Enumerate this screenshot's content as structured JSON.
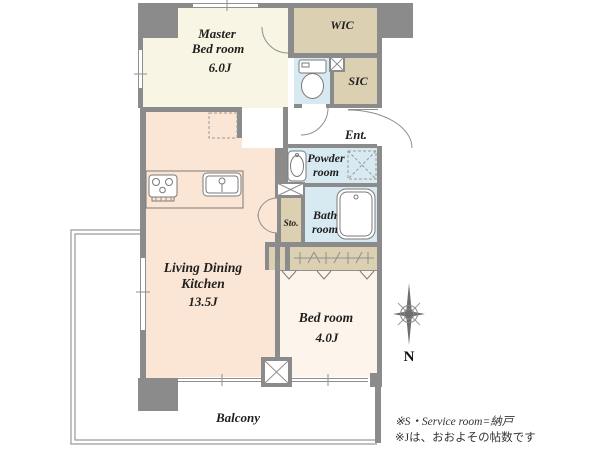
{
  "colors": {
    "wall": "#8b8b8b",
    "master_cream": "#f8f5e4",
    "closet_tan": "#dcd0b2",
    "water_blue": "#d8eaf1",
    "ldk_peach": "#fbe6d6",
    "bedroom_pink": "#fdf4ec"
  },
  "rooms": {
    "master_bedroom": {
      "line1": "Master",
      "line2": "Bed room",
      "size": "6.0J"
    },
    "wic": {
      "label": "WIC"
    },
    "sic": {
      "label": "SIC"
    },
    "entrance": {
      "label": "Ent."
    },
    "powder_room": {
      "line1": "Powder",
      "line2": "room"
    },
    "bath_room": {
      "line1": "Bath",
      "line2": "room"
    },
    "storage": {
      "label": "Sto."
    },
    "ldk": {
      "line1": "Living Dining",
      "line2": "Kitchen",
      "size": "13.5J"
    },
    "bedroom": {
      "name": "Bed room",
      "size": "4.0J"
    },
    "balcony": {
      "label": "Balcony"
    }
  },
  "compass": {
    "north_label": "N"
  },
  "footnotes": {
    "line1": "※S・Service room=納戸",
    "line2": "※Jは、おおよその帖数です"
  }
}
